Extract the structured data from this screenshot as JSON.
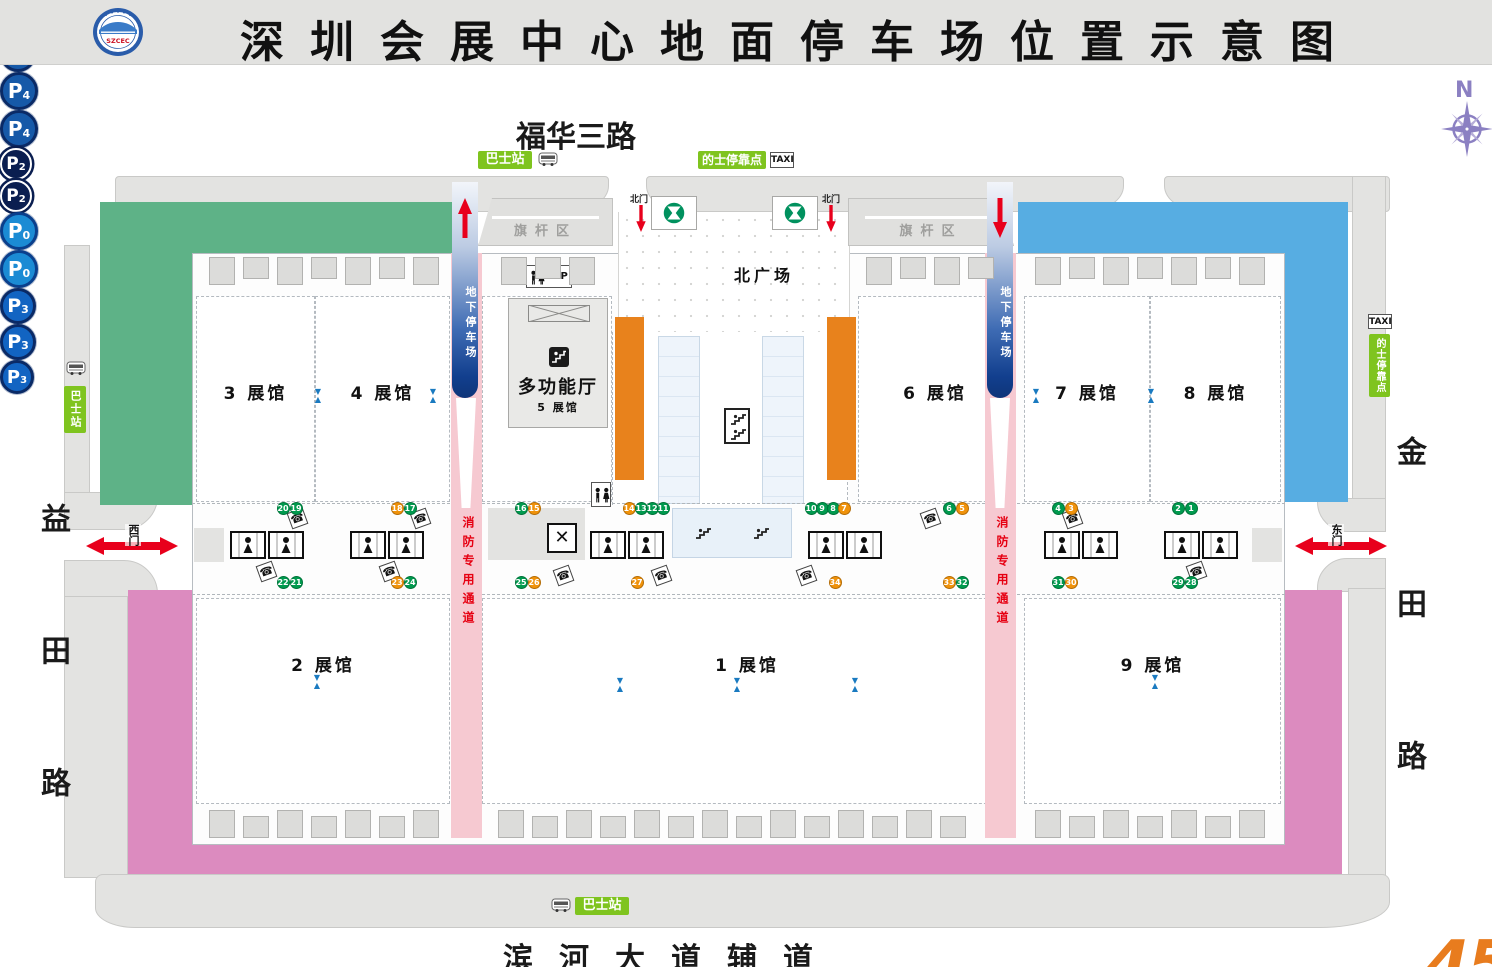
{
  "header": {
    "title": "深圳会展中心地面停车场位置示意图",
    "logo_text": "SZCEC"
  },
  "compass": {
    "label": "N"
  },
  "roads": {
    "top": "福华三路",
    "bottom": "滨河大道辅道",
    "left": "益田路",
    "right": "金田路"
  },
  "labels": {
    "north_plaza": "北广场",
    "flag_area": "旗杆区",
    "north_gate": "北门",
    "west_gate": "西门",
    "east_gate": "东门",
    "multi_hall": "多功能厅",
    "multi_hall_sub": "5 展馆",
    "vip": "VIP"
  },
  "transit": {
    "bus_station": "巴士站",
    "taxi_stop": "的士停靠点",
    "taxi": "TAXI"
  },
  "lanes": {
    "underground": "地下停车场",
    "fire": "消防专用通道"
  },
  "halls": {
    "h1": "1 展馆",
    "h2": "2 展馆",
    "h3": "3 展馆",
    "h4": "4 展馆",
    "h6": "6 展馆",
    "h7": "7 展馆",
    "h8": "8 展馆",
    "h9": "9 展馆"
  },
  "parking_marks": [
    {
      "id": "p1-top",
      "label": "P",
      "sub": "1",
      "x": 287,
      "y": 229,
      "d": 36,
      "fill": "#1659a8",
      "ring": "#0a2a66"
    },
    {
      "id": "p1-left",
      "label": "P",
      "sub": "1",
      "x": 152,
      "y": 369,
      "d": 36,
      "fill": "#1659a8",
      "ring": "#0a2a66"
    },
    {
      "id": "p4-top",
      "label": "P",
      "sub": "4",
      "x": 1168,
      "y": 227,
      "d": 38,
      "fill": "#1659a8",
      "ring": "#0a2a66"
    },
    {
      "id": "p4-right",
      "label": "P",
      "sub": "4",
      "x": 1312,
      "y": 368,
      "d": 38,
      "fill": "#1659a8",
      "ring": "#0a2a66"
    },
    {
      "id": "p2-left",
      "label": "P",
      "sub": "2",
      "x": 466,
      "y": 368,
      "d": 32,
      "fill": "#0a1e50",
      "ring": "#ffffff"
    },
    {
      "id": "p2-right",
      "label": "P",
      "sub": "2",
      "x": 1001,
      "y": 368,
      "d": 32,
      "fill": "#0a1e50",
      "ring": "#ffffff"
    },
    {
      "id": "p0-left",
      "label": "P",
      "sub": "0",
      "x": 629,
      "y": 431,
      "d": 38,
      "fill": "#1b8bd4",
      "ring": "#0a3f8c"
    },
    {
      "id": "p0-right",
      "label": "P",
      "sub": "0",
      "x": 841,
      "y": 431,
      "d": 38,
      "fill": "#1b8bd4",
      "ring": "#0a3f8c"
    },
    {
      "id": "p3-left",
      "label": "P",
      "sub": "3",
      "x": 157,
      "y": 712,
      "d": 36,
      "fill": "#1264c2",
      "ring": "#0a2a66"
    },
    {
      "id": "p3-right",
      "label": "P",
      "sub": "3",
      "x": 1312,
      "y": 714,
      "d": 36,
      "fill": "#1264c2",
      "ring": "#0a2a66"
    },
    {
      "id": "p3-bottom",
      "label": "P",
      "sub": "3",
      "x": 657,
      "y": 855,
      "d": 34,
      "fill": "#1264c2",
      "ring": "#0a2a66"
    }
  ],
  "gate_badges": [
    {
      "n": "20",
      "c": "g",
      "x": 283,
      "y": 508
    },
    {
      "n": "19",
      "c": "g",
      "x": 296,
      "y": 508
    },
    {
      "n": "18",
      "c": "o",
      "x": 397,
      "y": 508
    },
    {
      "n": "17",
      "c": "g",
      "x": 410,
      "y": 508
    },
    {
      "n": "16",
      "c": "g",
      "x": 521,
      "y": 508
    },
    {
      "n": "15",
      "c": "o",
      "x": 534,
      "y": 508
    },
    {
      "n": "14",
      "c": "o",
      "x": 629,
      "y": 508
    },
    {
      "n": "13",
      "c": "g",
      "x": 641,
      "y": 508
    },
    {
      "n": "12",
      "c": "g",
      "x": 652,
      "y": 508
    },
    {
      "n": "11",
      "c": "g",
      "x": 663,
      "y": 508
    },
    {
      "n": "10",
      "c": "g",
      "x": 811,
      "y": 508
    },
    {
      "n": "9",
      "c": "g",
      "x": 822,
      "y": 508
    },
    {
      "n": "8",
      "c": "g",
      "x": 833,
      "y": 508
    },
    {
      "n": "7",
      "c": "o",
      "x": 844,
      "y": 508
    },
    {
      "n": "6",
      "c": "g",
      "x": 949,
      "y": 508
    },
    {
      "n": "5",
      "c": "o",
      "x": 962,
      "y": 508
    },
    {
      "n": "4",
      "c": "g",
      "x": 1058,
      "y": 508
    },
    {
      "n": "3",
      "c": "o",
      "x": 1071,
      "y": 508
    },
    {
      "n": "2",
      "c": "g",
      "x": 1178,
      "y": 508
    },
    {
      "n": "1",
      "c": "g",
      "x": 1191,
      "y": 508
    },
    {
      "n": "22",
      "c": "g",
      "x": 283,
      "y": 582
    },
    {
      "n": "21",
      "c": "g",
      "x": 296,
      "y": 582
    },
    {
      "n": "23",
      "c": "o",
      "x": 397,
      "y": 582
    },
    {
      "n": "24",
      "c": "g",
      "x": 410,
      "y": 582
    },
    {
      "n": "25",
      "c": "g",
      "x": 521,
      "y": 582
    },
    {
      "n": "26",
      "c": "o",
      "x": 534,
      "y": 582
    },
    {
      "n": "27",
      "c": "o",
      "x": 637,
      "y": 582
    },
    {
      "n": "34",
      "c": "o",
      "x": 835,
      "y": 582
    },
    {
      "n": "33",
      "c": "o",
      "x": 949,
      "y": 582
    },
    {
      "n": "32",
      "c": "g",
      "x": 962,
      "y": 582
    },
    {
      "n": "31",
      "c": "g",
      "x": 1058,
      "y": 582
    },
    {
      "n": "30",
      "c": "o",
      "x": 1071,
      "y": 582
    },
    {
      "n": "29",
      "c": "g",
      "x": 1178,
      "y": 582
    },
    {
      "n": "28",
      "c": "g",
      "x": 1191,
      "y": 582
    }
  ],
  "corner_mark": "45",
  "colors": {
    "p1_area": "#5eb287",
    "p4_area": "#57ade2",
    "p3_area": "#dc8bbf",
    "p0_strip": "#e8821c",
    "fire_lane": "#f6c9d1",
    "fire_text": "#e60012",
    "road": "#e3e3e1",
    "badge_green": "#009a4e",
    "badge_orange": "#f0920a",
    "label_green": "#7fc41f",
    "metro_green": "#00915e",
    "arrow_red": "#e8001c",
    "compass": "#8b80c2",
    "corner_mark_color": "#e87c1e"
  }
}
